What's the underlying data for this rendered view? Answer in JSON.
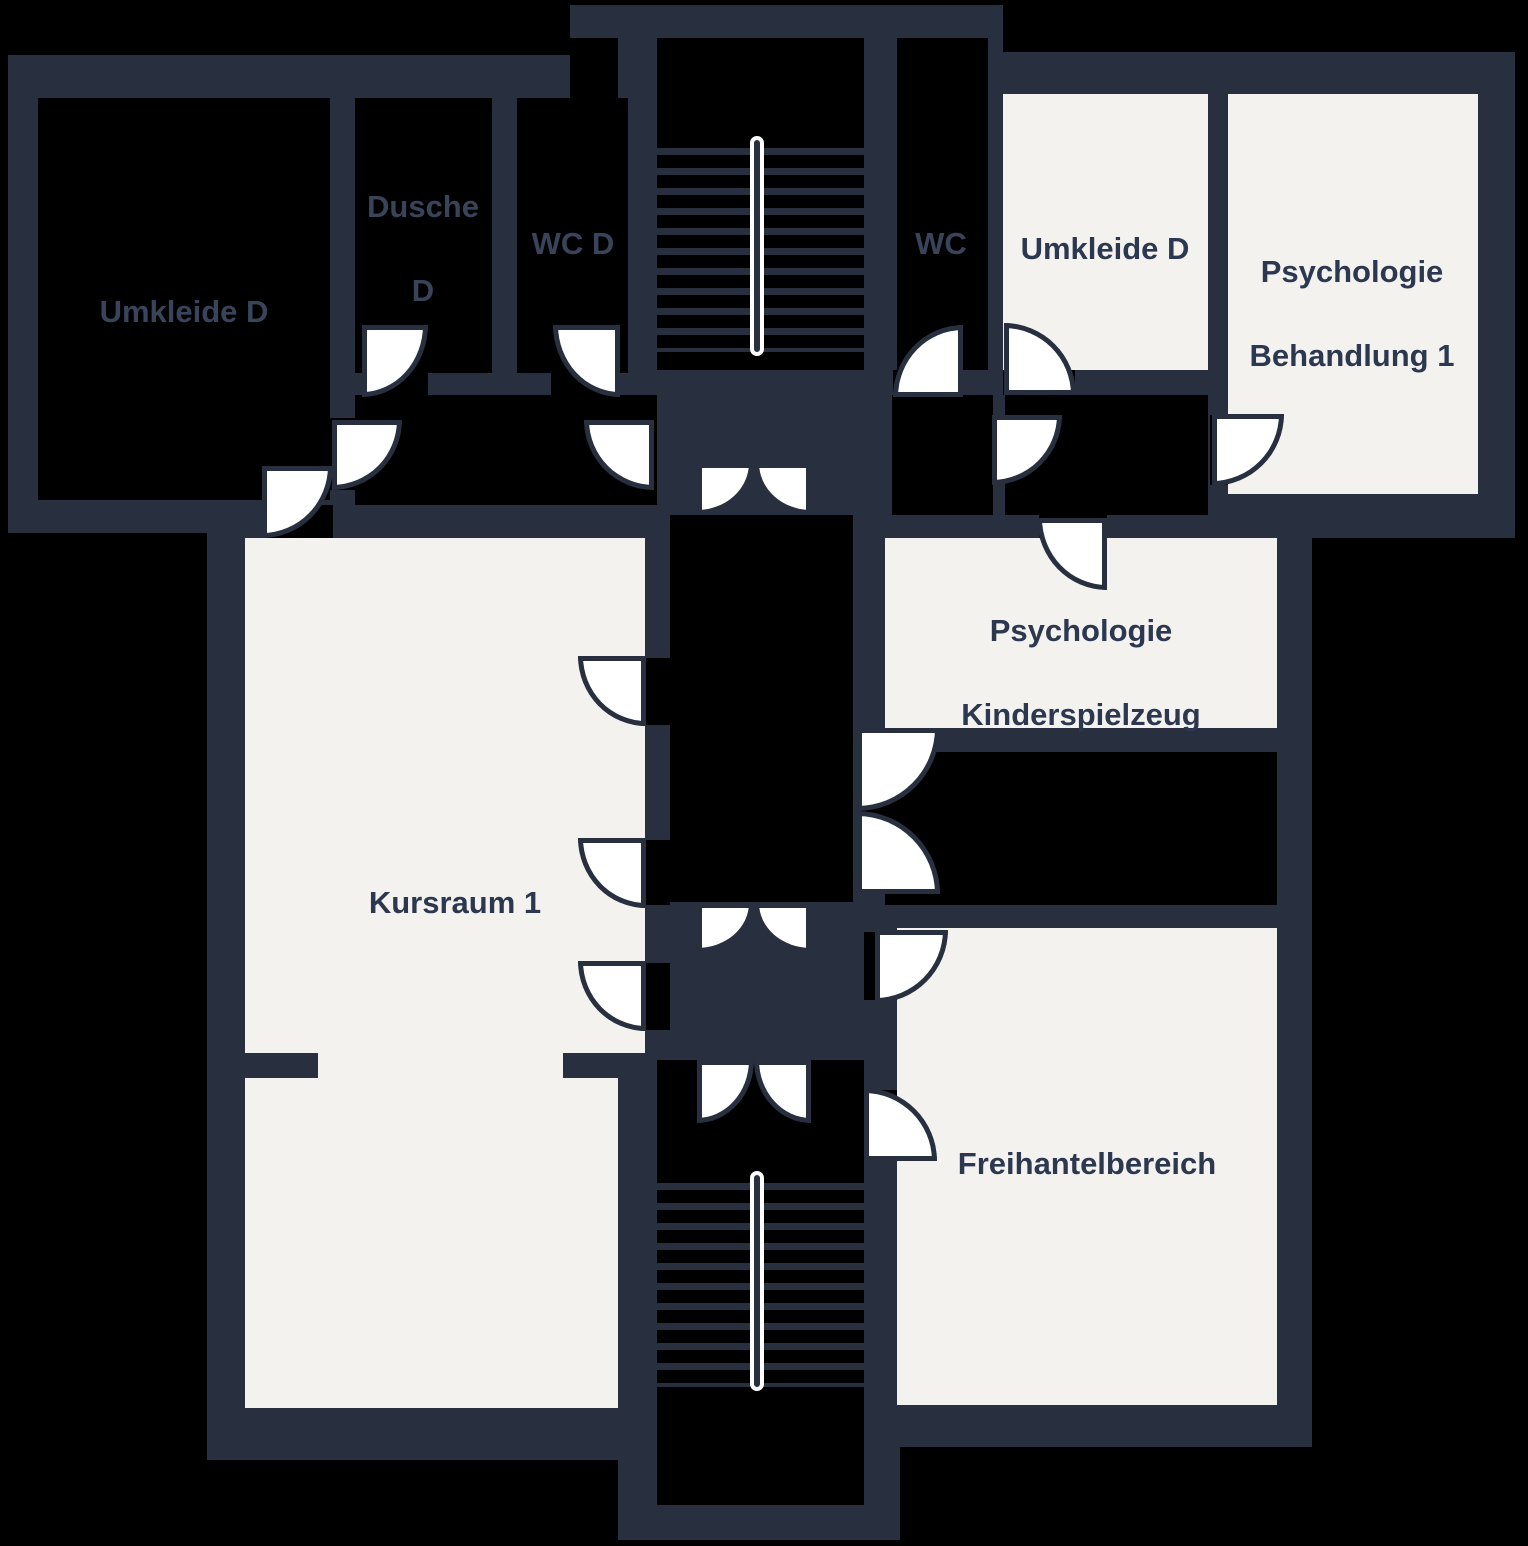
{
  "title": "Floor plan",
  "colors": {
    "background": "#000000",
    "wall": "#28303F",
    "room_fill": "#F4F2EF",
    "door_fill": "#FFFFFF",
    "label_on_dark_room": "#39445A",
    "label_on_light_room": "#2C3850"
  },
  "rooms": {
    "umkleide_d_left": {
      "line1": "Umkleide D",
      "line2": ""
    },
    "dusche_d": {
      "line1": "Dusche",
      "line2": "D"
    },
    "wc_d": {
      "line1": "WC D",
      "line2": ""
    },
    "wc": {
      "line1": "WC",
      "line2": ""
    },
    "umkleide_d_right": {
      "line1": "Umkleide D",
      "line2": ""
    },
    "psychologie_behandlung_1": {
      "line1": "Psychologie",
      "line2": "Behandlung 1"
    },
    "psychologie_kinderspielzeug": {
      "line1": "Psychologie",
      "line2": "Kinderspielzeug"
    },
    "kursraum_1": {
      "line1": "Kursraum 1",
      "line2": ""
    },
    "freihantelbereich": {
      "line1": "Freihantelbereich",
      "line2": ""
    }
  }
}
